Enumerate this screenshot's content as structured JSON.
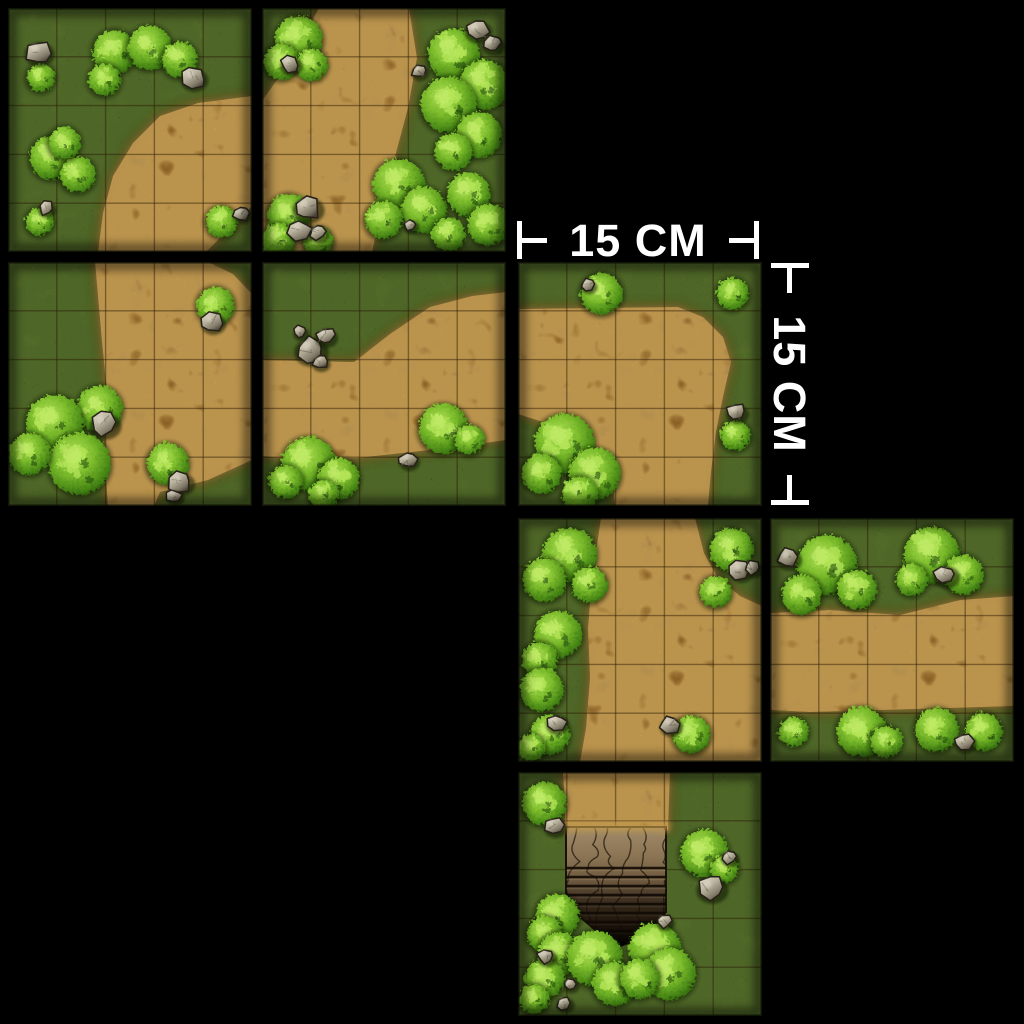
{
  "scene": {
    "background": "#000000",
    "description": "Sheet of eight square 15 cm outdoor battle-map tiles (grass with dirt paths, bushes, rocks and one stone stairway) arranged on a black background",
    "tile_size_px": 244,
    "grid_squares_per_tile": 5,
    "tile_real_size": "15 CM"
  },
  "scale_labels": {
    "horizontal": {
      "text": "15 CM",
      "left_marker": "⊢",
      "right_marker": "⊣",
      "color": "#ffffff"
    },
    "vertical": {
      "text": "15 CM",
      "top_marker": "⊤",
      "bottom_marker": "⊥",
      "color": "#ffffff"
    }
  },
  "palette": {
    "background": "#000000",
    "grass": "#4f731d",
    "grass_light": "#7d9c33",
    "grass_dark": "#2c4a0e",
    "grass_speckle_dark": "#16240a",
    "grass_speckle_light": "#9cc04f",
    "dirt": "#c29a4c",
    "dirt_rim": "#4a2c0a",
    "dirt_speckle": "#4e2e0a",
    "dirt_red": "#95601f",
    "dirt_light": "#e6c372",
    "bush": "#7cbc2c",
    "bush_light": "#b6e65a",
    "bush_dark": "#1e4408",
    "rock": "#b9b29e",
    "rock_light": "#e6e0cf",
    "rock_dark": "#4c463a",
    "stone_stairs": "#8a7454",
    "grid_line": "#2a1804",
    "label_text": "#ffffff"
  },
  "tiles": [
    {
      "id": "a",
      "x": 8,
      "y": 8,
      "terrain": "grass with dirt path from right edge to bottom edge",
      "path": [
        [
          244,
          88
        ],
        [
          190,
          95
        ],
        [
          152,
          108
        ],
        [
          125,
          135
        ],
        [
          105,
          168
        ],
        [
          95,
          205
        ],
        [
          90,
          244
        ],
        [
          198,
          244
        ],
        [
          244,
          198
        ]
      ],
      "bushes": [
        [
          31,
          68,
          14
        ],
        [
          105,
          42,
          22
        ],
        [
          140,
          38,
          22
        ],
        [
          170,
          50,
          18
        ],
        [
          95,
          70,
          16
        ],
        [
          42,
          148,
          22
        ],
        [
          68,
          165,
          18
        ],
        [
          55,
          133,
          16
        ],
        [
          30,
          212,
          14
        ],
        [
          212,
          212,
          16
        ]
      ],
      "rocks": [
        [
          30,
          44,
          13
        ],
        [
          185,
          70,
          12
        ],
        [
          38,
          200,
          8
        ],
        [
          233,
          206,
          8
        ]
      ]
    },
    {
      "id": "b",
      "x": 262,
      "y": 8,
      "terrain": "dirt path from top edge widening to left and bottom, dense bushes on right",
      "path": [
        [
          57,
          0
        ],
        [
          147,
          0
        ],
        [
          155,
          50
        ],
        [
          146,
          100
        ],
        [
          134,
          145
        ],
        [
          122,
          190
        ],
        [
          110,
          244
        ],
        [
          0,
          244
        ],
        [
          0,
          93
        ],
        [
          22,
          62
        ],
        [
          40,
          32
        ]
      ],
      "bushes": [
        [
          35,
          30,
          24
        ],
        [
          18,
          52,
          18
        ],
        [
          48,
          55,
          16
        ],
        [
          190,
          45,
          26
        ],
        [
          220,
          75,
          25
        ],
        [
          185,
          95,
          28
        ],
        [
          215,
          125,
          23
        ],
        [
          190,
          142,
          19
        ],
        [
          135,
          175,
          26
        ],
        [
          160,
          200,
          23
        ],
        [
          120,
          210,
          19
        ],
        [
          205,
          185,
          22
        ],
        [
          225,
          215,
          21
        ],
        [
          185,
          225,
          17
        ],
        [
          25,
          205,
          21
        ],
        [
          15,
          230,
          17
        ],
        [
          55,
          232,
          15
        ]
      ],
      "rocks": [
        [
          28,
          56,
          10
        ],
        [
          215,
          22,
          12
        ],
        [
          230,
          36,
          10
        ],
        [
          157,
          63,
          8
        ],
        [
          45,
          200,
          14
        ],
        [
          38,
          222,
          12
        ],
        [
          56,
          224,
          9
        ],
        [
          148,
          217,
          7
        ]
      ]
    },
    {
      "id": "c",
      "x": 8,
      "y": 262,
      "terrain": "dirt path from top edge branching to right and bottom edges",
      "path": [
        [
          87,
          0
        ],
        [
          200,
          0
        ],
        [
          225,
          12
        ],
        [
          244,
          32
        ],
        [
          244,
          198
        ],
        [
          200,
          218
        ],
        [
          152,
          230
        ],
        [
          146,
          244
        ],
        [
          100,
          244
        ],
        [
          96,
          192
        ],
        [
          100,
          140
        ],
        [
          94,
          80
        ]
      ],
      "bushes": [
        [
          206,
          42,
          19
        ],
        [
          90,
          145,
          23
        ],
        [
          45,
          160,
          29
        ],
        [
          70,
          200,
          31
        ],
        [
          20,
          190,
          21
        ],
        [
          158,
          200,
          21
        ]
      ],
      "rocks": [
        [
          204,
          60,
          11
        ],
        [
          96,
          162,
          14
        ],
        [
          172,
          220,
          12
        ],
        [
          166,
          234,
          8
        ]
      ]
    },
    {
      "id": "d",
      "x": 262,
      "y": 262,
      "terrain": "horizontal dirt path widening toward top right corner, rock pile at left",
      "path": [
        [
          0,
          98
        ],
        [
          92,
          100
        ],
        [
          128,
          72
        ],
        [
          168,
          45
        ],
        [
          210,
          34
        ],
        [
          244,
          30
        ],
        [
          244,
          178
        ],
        [
          195,
          185
        ],
        [
          150,
          190
        ],
        [
          95,
          196
        ],
        [
          40,
          198
        ],
        [
          0,
          194
        ]
      ],
      "bushes": [
        [
          45,
          200,
          27
        ],
        [
          75,
          215,
          21
        ],
        [
          22,
          218,
          17
        ],
        [
          60,
          231,
          15
        ],
        [
          180,
          165,
          25
        ],
        [
          206,
          176,
          15
        ]
      ],
      "rocks": [
        [
          48,
          88,
          15
        ],
        [
          63,
          74,
          10
        ],
        [
          58,
          100,
          8
        ],
        [
          38,
          70,
          7
        ],
        [
          146,
          198,
          9
        ]
      ]
    },
    {
      "id": "e",
      "x": 518,
      "y": 262,
      "terrain": "dirt path from left edge bending down to bottom edge, large bush lower left",
      "path": [
        [
          0,
          47
        ],
        [
          160,
          45
        ],
        [
          185,
          55
        ],
        [
          205,
          75
        ],
        [
          213,
          100
        ],
        [
          205,
          135
        ],
        [
          198,
          170
        ],
        [
          193,
          210
        ],
        [
          190,
          244
        ],
        [
          97,
          244
        ],
        [
          94,
          205
        ],
        [
          60,
          175
        ],
        [
          25,
          160
        ],
        [
          0,
          152
        ]
      ],
      "bushes": [
        [
          82,
          30,
          21
        ],
        [
          213,
          30,
          16
        ],
        [
          45,
          180,
          30
        ],
        [
          75,
          210,
          26
        ],
        [
          22,
          210,
          20
        ],
        [
          60,
          230,
          18
        ],
        [
          216,
          172,
          15
        ]
      ],
      "rocks": [
        [
          70,
          23,
          7
        ],
        [
          218,
          150,
          10
        ]
      ]
    },
    {
      "id": "f",
      "x": 518,
      "y": 518,
      "terrain": "dirt path from top edge opening to right and bottom, bush line along left edge",
      "path": [
        [
          83,
          0
        ],
        [
          177,
          0
        ],
        [
          186,
          35
        ],
        [
          200,
          60
        ],
        [
          222,
          78
        ],
        [
          244,
          88
        ],
        [
          244,
          244
        ],
        [
          62,
          244
        ],
        [
          68,
          210
        ],
        [
          72,
          160
        ],
        [
          70,
          110
        ],
        [
          74,
          60
        ]
      ],
      "bushes": [
        [
          50,
          35,
          27
        ],
        [
          25,
          60,
          22
        ],
        [
          70,
          65,
          18
        ],
        [
          38,
          115,
          24
        ],
        [
          20,
          140,
          18
        ],
        [
          22,
          170,
          22
        ],
        [
          30,
          215,
          20
        ],
        [
          12,
          228,
          14
        ],
        [
          172,
          215,
          19
        ],
        [
          212,
          30,
          22
        ],
        [
          196,
          72,
          16
        ]
      ],
      "rocks": [
        [
          38,
          205,
          10
        ],
        [
          152,
          207,
          10
        ],
        [
          222,
          52,
          11
        ],
        [
          235,
          50,
          8
        ]
      ]
    },
    {
      "id": "g",
      "x": 770,
      "y": 518,
      "terrain": "horizontal dirt path with bushes along top and bottom edges",
      "path": [
        [
          0,
          95
        ],
        [
          60,
          92
        ],
        [
          130,
          97
        ],
        [
          190,
          82
        ],
        [
          244,
          78
        ],
        [
          244,
          188
        ],
        [
          180,
          190
        ],
        [
          110,
          192
        ],
        [
          40,
          194
        ],
        [
          0,
          192
        ]
      ],
      "bushes": [
        [
          55,
          45,
          30
        ],
        [
          30,
          75,
          20
        ],
        [
          85,
          70,
          20
        ],
        [
          160,
          35,
          28
        ],
        [
          192,
          55,
          20
        ],
        [
          140,
          60,
          16
        ],
        [
          22,
          212,
          15
        ],
        [
          90,
          212,
          25
        ],
        [
          115,
          222,
          16
        ],
        [
          165,
          210,
          22
        ],
        [
          212,
          212,
          19
        ]
      ],
      "rocks": [
        [
          18,
          40,
          11
        ],
        [
          175,
          57,
          12
        ],
        [
          194,
          224,
          10
        ]
      ]
    },
    {
      "id": "h",
      "x": 518,
      "y": 772,
      "terrain": "dirt path from top edge ending in cracked stone stairway descending underground, ringed by bushes",
      "path": [
        [
          45,
          0
        ],
        [
          152,
          0
        ],
        [
          150,
          58
        ],
        [
          48,
          58
        ]
      ],
      "stairs": {
        "points": [
          [
            48,
            55
          ],
          [
            148,
            55
          ],
          [
            148,
            140
          ],
          [
            126,
            165
          ],
          [
            100,
            175
          ],
          [
            82,
            162
          ],
          [
            62,
            145
          ],
          [
            48,
            125
          ]
        ],
        "step_ys": [
          96,
          105,
          114,
          123,
          132,
          141,
          150,
          159
        ]
      },
      "bushes": [
        [
          25,
          30,
          22
        ],
        [
          185,
          80,
          24
        ],
        [
          205,
          95,
          14
        ],
        [
          38,
          142,
          22
        ],
        [
          25,
          160,
          18
        ],
        [
          40,
          180,
          22
        ],
        [
          75,
          185,
          28
        ],
        [
          95,
          210,
          22
        ],
        [
          135,
          175,
          26
        ],
        [
          150,
          200,
          26
        ],
        [
          120,
          205,
          20
        ],
        [
          25,
          205,
          20
        ],
        [
          15,
          225,
          15
        ]
      ],
      "rocks": [
        [
          36,
          54,
          10
        ],
        [
          211,
          85,
          8
        ],
        [
          193,
          116,
          14
        ],
        [
          28,
          184,
          9
        ],
        [
          146,
          149,
          8
        ],
        [
          52,
          212,
          7
        ],
        [
          46,
          231,
          8
        ]
      ]
    }
  ]
}
